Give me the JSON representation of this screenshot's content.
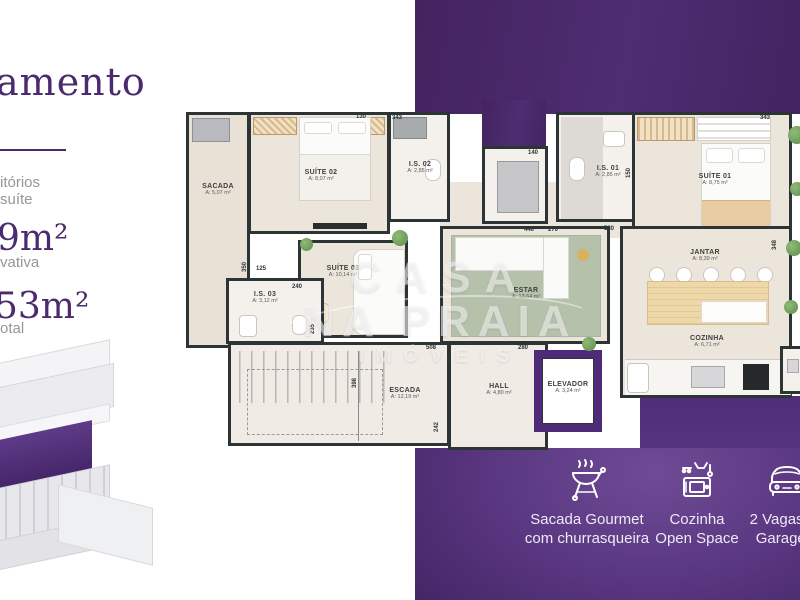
{
  "header": {
    "headline_fragment": "amento"
  },
  "sidebar": {
    "line1_fragment": "itórios",
    "line2_fragment": "suíte",
    "stat1": {
      "value": "9m²",
      "label_fragment": "vativa"
    },
    "stat2": {
      "value": "53m²",
      "label_fragment": "otal"
    }
  },
  "floorplan": {
    "rooms": {
      "sacada": {
        "name": "SACADA",
        "area": "A: 5,07 m²"
      },
      "suite02": {
        "name": "SUÍTE 02",
        "area": "A: 8,07 m²"
      },
      "is02": {
        "name": "I.S. 02",
        "area": "A: 2,85 m²"
      },
      "is01": {
        "name": "I.S. 01",
        "area": "A: 2,85 m²"
      },
      "suite01": {
        "name": "SUÍTE 01",
        "area": "A: 8,75 m²"
      },
      "circulacao": {
        "name": "CIRCULAÇÃO",
        "area": "A: 5,22 m²"
      },
      "suite03": {
        "name": "SUÍTE 03",
        "area": "A: 10,14 m²"
      },
      "is03": {
        "name": "I.S. 03",
        "area": "A: 3,12 m²"
      },
      "estar": {
        "name": "ESTAR",
        "area": "A: 13,64 m²"
      },
      "jantar": {
        "name": "JANTAR",
        "area": "A: 8,39 m²"
      },
      "cozinha": {
        "name": "COZINHA",
        "area": "A: 6,71 m²"
      },
      "escada": {
        "name": "ESCADA",
        "area": "A: 12,19 m²"
      },
      "hall": {
        "name": "HALL",
        "area": "A: 4,80 m²"
      },
      "elevador": {
        "name": "ELEVADOR",
        "area": "A: 3,24 m²"
      }
    },
    "dimensions": [
      "130",
      "343",
      "343",
      "140",
      "440",
      "270",
      "580",
      "150",
      "125",
      "350",
      "240",
      "235",
      "508",
      "280",
      "398",
      "242",
      "348"
    ],
    "watermark": {
      "line1": "CASA",
      "line2": "NA PRAIA",
      "line3": "IMÓVEIS"
    }
  },
  "amenities": [
    {
      "icon": "grill-icon",
      "line1": "Sacada Gourmet",
      "line2": "com churrasqueira"
    },
    {
      "icon": "kitchen-icon",
      "line1": "Cozinha",
      "line2": "Open Space"
    },
    {
      "icon": "car-icon",
      "line1": "2 Vagas de",
      "line2": "Garagem"
    }
  ],
  "colors": {
    "brand_purple": "#4b2a6f",
    "panel_purple_light": "#6f4b96",
    "panel_purple_dark": "#391d58",
    "wall": "#2d3436",
    "elevator_purple": "#4f2a78",
    "rug_green": "#b5c1ab",
    "wood_tan": "#eed7a8"
  }
}
